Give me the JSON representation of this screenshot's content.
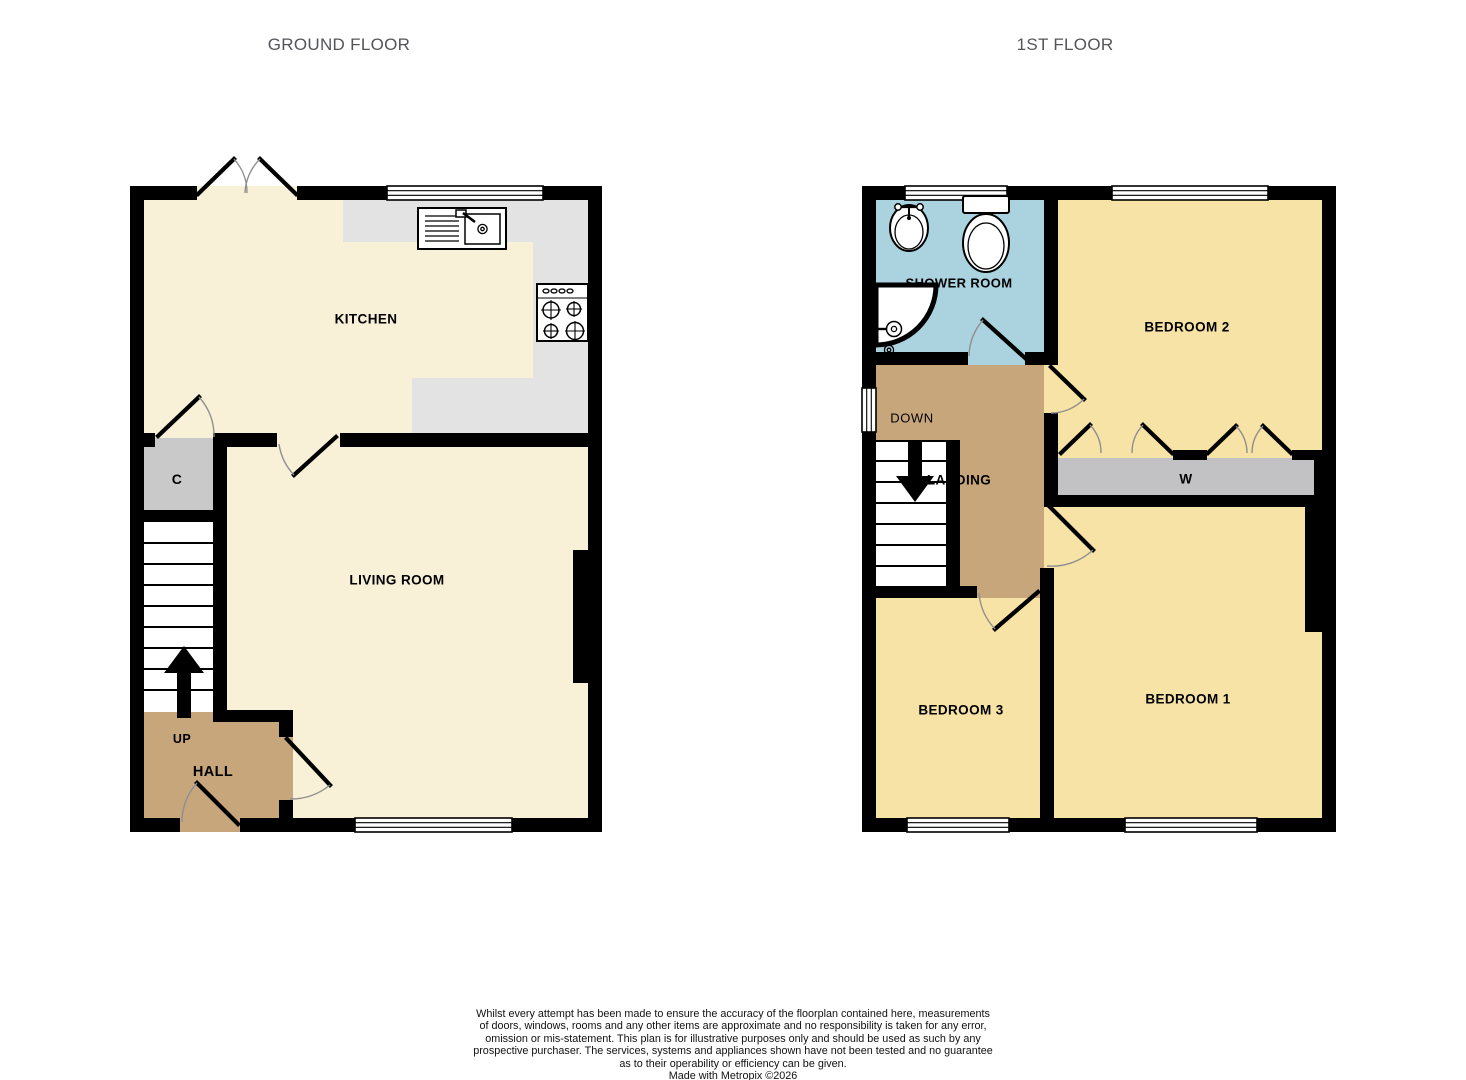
{
  "colors": {
    "wall": "#000000",
    "cream": "#F8F1D7",
    "bedroom_yellow": "#F6E3A5",
    "hall_tan": "#C7A67B",
    "shower_blue": "#ABD2DF",
    "counter_gray": "#E3E3E3",
    "cupboard_gray": "#C9C9C9",
    "wardrobe_gray": "#C2C2C4",
    "title_gray": "#54555A"
  },
  "ground_floor": {
    "title": "GROUND FLOOR",
    "labels": {
      "kitchen": "KITCHEN",
      "cupboard": "C",
      "living_room": "LIVING ROOM",
      "stairs_direction": "UP",
      "hall": "HALL"
    }
  },
  "first_floor": {
    "title": "1ST FLOOR",
    "labels": {
      "shower_room": "SHOWER ROOM",
      "bedroom2": "BEDROOM 2",
      "stairs_direction": "DOWN",
      "landing": "LANDING",
      "wardrobe": "W",
      "bedroom3": "BEDROOM 3",
      "bedroom1": "BEDROOM 1"
    }
  },
  "disclaimer": {
    "lines": [
      "Whilst every attempt has been made to ensure the accuracy of the floorplan contained here, measurements",
      "of doors, windows, rooms and any other items are approximate and no responsibility is taken for any error,",
      "omission or mis-statement. This plan is for illustrative purposes only and should be used as such by any",
      "prospective purchaser. The services, systems and appliances shown have not been tested and no guarantee",
      "as to their operability or efficiency can be given."
    ],
    "credit": "Made with Metropix ©2026"
  }
}
